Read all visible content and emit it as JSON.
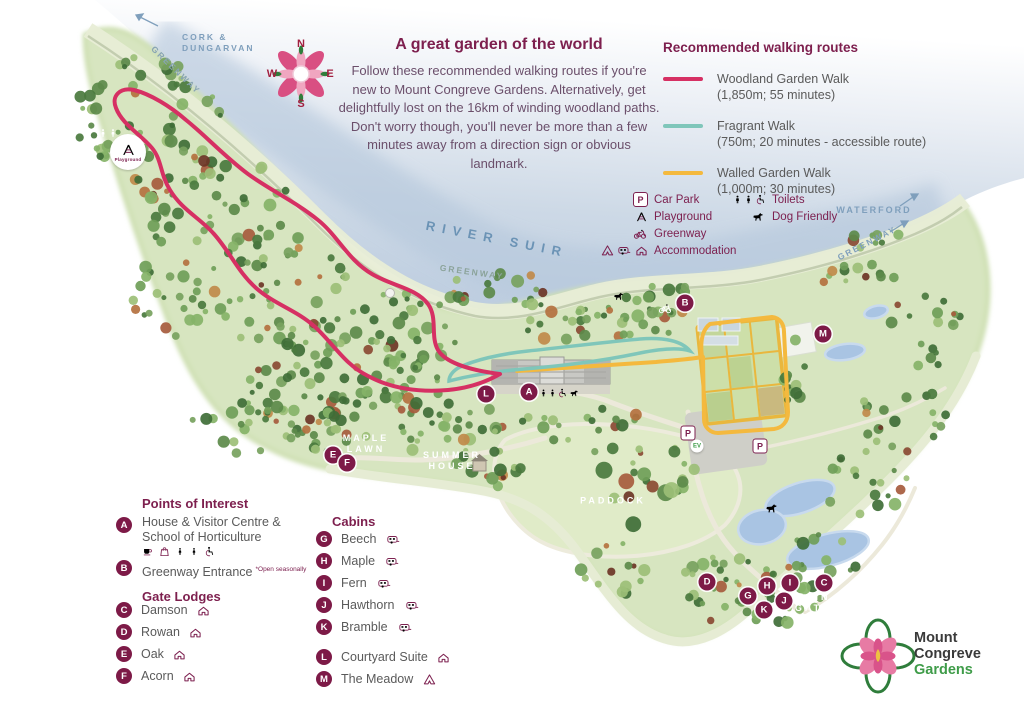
{
  "intro": {
    "title": "A great garden of the world",
    "body": "Follow these recommended walking routes if you're new to Mount Congreve Gardens. Alternatively, get delightfully lost on the 16km of winding woodland paths. Don't worry though, you'll never be more than a few minutes away from a direction sign or obvious landmark."
  },
  "routes_legend": {
    "title": "Recommended walking routes",
    "items": [
      {
        "name": "Woodland Garden Walk",
        "detail": "(1,850m; 55 minutes)",
        "color": "#d63063"
      },
      {
        "name": "Fragrant Walk",
        "detail": "(750m; 20 minutes - accessible route)",
        "color": "#7fc6ba"
      },
      {
        "name": "Walled Garden Walk",
        "detail": "(1,000m; 30 minutes)",
        "color": "#f4b93e"
      }
    ]
  },
  "facilities_legend": {
    "col1": [
      {
        "icon": "car-park-icon",
        "label": "Car Park"
      },
      {
        "icon": "playground-icon",
        "label": "Playground"
      },
      {
        "icon": "greenway-icon",
        "label": "Greenway"
      },
      {
        "icon": "accommodation-icon",
        "label": "Accommodation"
      }
    ],
    "col2": [
      {
        "icon": "toilets-icon",
        "label": "Toilets"
      },
      {
        "icon": "dog-friendly-icon",
        "label": "Dog Friendly"
      }
    ]
  },
  "points_of_interest": {
    "title": "Points of Interest",
    "item_a": {
      "letter": "A",
      "label": "House & Visitor Centre & School of Horticulture"
    },
    "item_b": {
      "letter": "B",
      "label": "Greenway Entrance",
      "note": "*Open seasonally"
    }
  },
  "gate_lodges": {
    "title": "Gate Lodges",
    "items": [
      {
        "letter": "C",
        "label": "Damson"
      },
      {
        "letter": "D",
        "label": "Rowan"
      },
      {
        "letter": "E",
        "label": "Oak"
      },
      {
        "letter": "F",
        "label": "Acorn"
      }
    ]
  },
  "cabins": {
    "title": "Cabins",
    "items": [
      {
        "letter": "G",
        "label": "Beech"
      },
      {
        "letter": "H",
        "label": "Maple"
      },
      {
        "letter": "I",
        "label": "Fern"
      },
      {
        "letter": "J",
        "label": "Hawthorn"
      },
      {
        "letter": "K",
        "label": "Bramble"
      }
    ],
    "courtyard": {
      "letter": "L",
      "label": "Courtyard Suite"
    },
    "meadow": {
      "letter": "M",
      "label": "The Meadow"
    }
  },
  "map_markers": [
    {
      "letter": "A"
    },
    {
      "letter": "B"
    },
    {
      "letter": "C"
    },
    {
      "letter": "D"
    },
    {
      "letter": "E"
    },
    {
      "letter": "F"
    },
    {
      "letter": "G"
    },
    {
      "letter": "H"
    },
    {
      "letter": "I"
    },
    {
      "letter": "J"
    },
    {
      "letter": "K"
    },
    {
      "letter": "L"
    },
    {
      "letter": "M"
    }
  ],
  "map_labels": {
    "cork_line1": "CORK &",
    "cork_line2": "DUNGARVAN",
    "greenway": "GREENWAY",
    "river": "RIVER SUIR",
    "waterford": "WATERFORD",
    "maple_line1": "MAPLE",
    "maple_line2": "LAWN",
    "summer_line1": "SUMMER",
    "summer_line2": "HOUSE",
    "paddock": "PADDOCK",
    "maingate_line1": "MAIN",
    "maingate_line2": "GATE"
  },
  "badges": {
    "p": "P",
    "ev": "EV",
    "playground": "Playground"
  },
  "compass": {
    "n": "N",
    "e": "E",
    "s": "S",
    "w": "W"
  },
  "logo": {
    "line1": "Mount",
    "line2": "Congreve",
    "line3": "Gardens"
  },
  "colors": {
    "heading": "#7d1f4e",
    "body_text": "#6b4f6b",
    "marker": "#7d1a47",
    "water": "#bccede",
    "land": "#d7e5c0",
    "pond": "#a9c4e3"
  }
}
